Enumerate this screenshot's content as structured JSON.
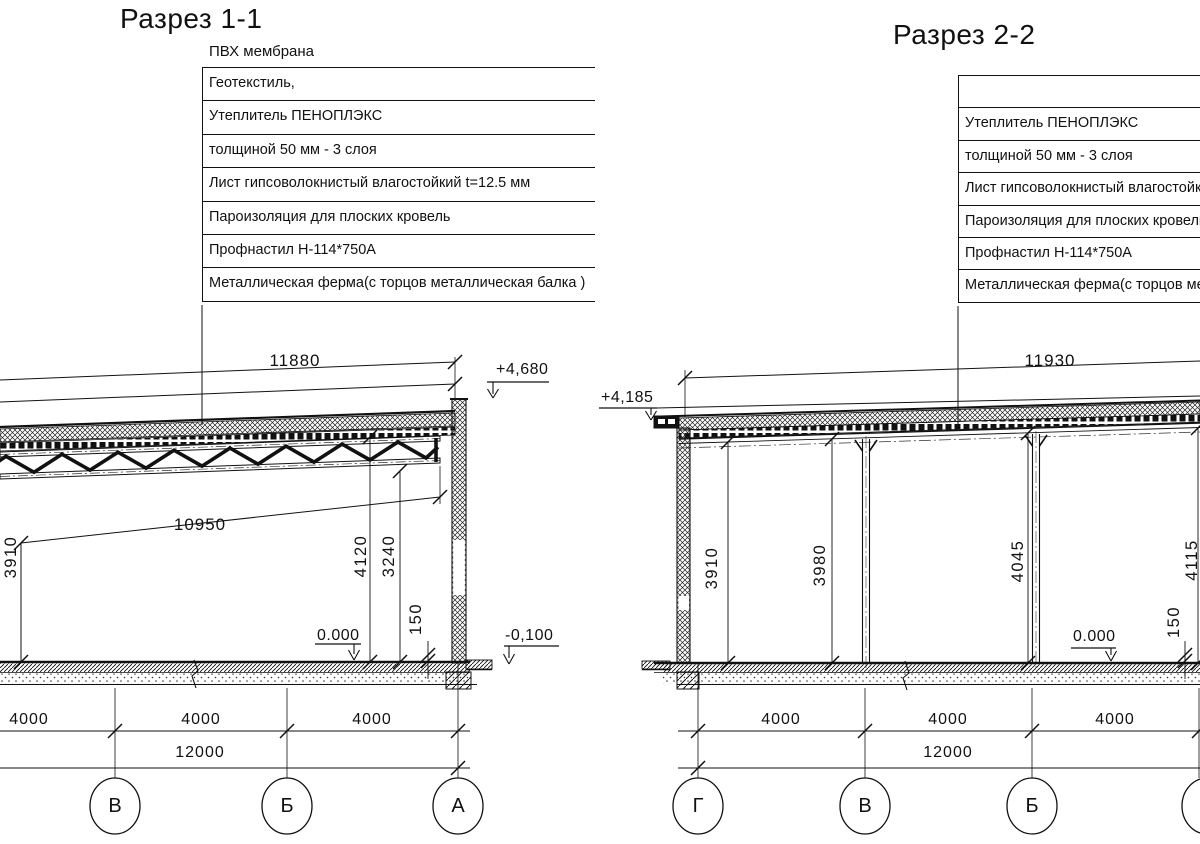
{
  "page": {
    "background": "#ffffff",
    "ink": "#111111"
  },
  "section1": {
    "title": "Разрез 1-1",
    "roof_top_label": "ПВХ мембрана",
    "callouts": [
      "Геотекстиль,",
      "Утеплитель ПЕНОПЛЭКС",
      "толщиной 50 мм - 3 слоя",
      "Лист гипсоволокнистый влагостойкий t=12.5 мм",
      "Пароизоляция для плоских кровель",
      "Профнастил Н-114*750А",
      "Металлическая ферма(с торцов металлическая балка )"
    ],
    "dims": {
      "roof_span": "11880",
      "clear_span": "10950",
      "height_wall": "3910",
      "height_truss_top": "4120",
      "height_truss_bottom": "3240",
      "slab_thickness": "150",
      "level_zero": "0.000",
      "level_minus": "-0,100",
      "level_parapet": "+4,680",
      "spans": [
        "4000",
        "4000",
        "4000"
      ],
      "total": "12000"
    },
    "axes": [
      "В",
      "Б",
      "А"
    ]
  },
  "section2": {
    "title": "Разрез 2-2",
    "callouts": [
      "",
      "Утеплитель ПЕНОПЛЭКС",
      "толщиной 50 мм - 3 слоя",
      "Лист гипсоволокнистый влагостойкий t=12.5 мм",
      "Пароизоляция для плоских кровель",
      "Профнастил Н-114*750А",
      "Металлическая ферма(с торцов металлическая балка )"
    ],
    "dims": {
      "roof_span": "11930",
      "heights": [
        "3910",
        "3980",
        "4045",
        "4115"
      ],
      "slab_thickness": "150",
      "level_zero": "0.000",
      "level_roof": "+4,185",
      "spans": [
        "4000",
        "4000",
        "4000"
      ],
      "total": "12000"
    },
    "axes": [
      "Г",
      "В",
      "Б",
      ""
    ]
  }
}
